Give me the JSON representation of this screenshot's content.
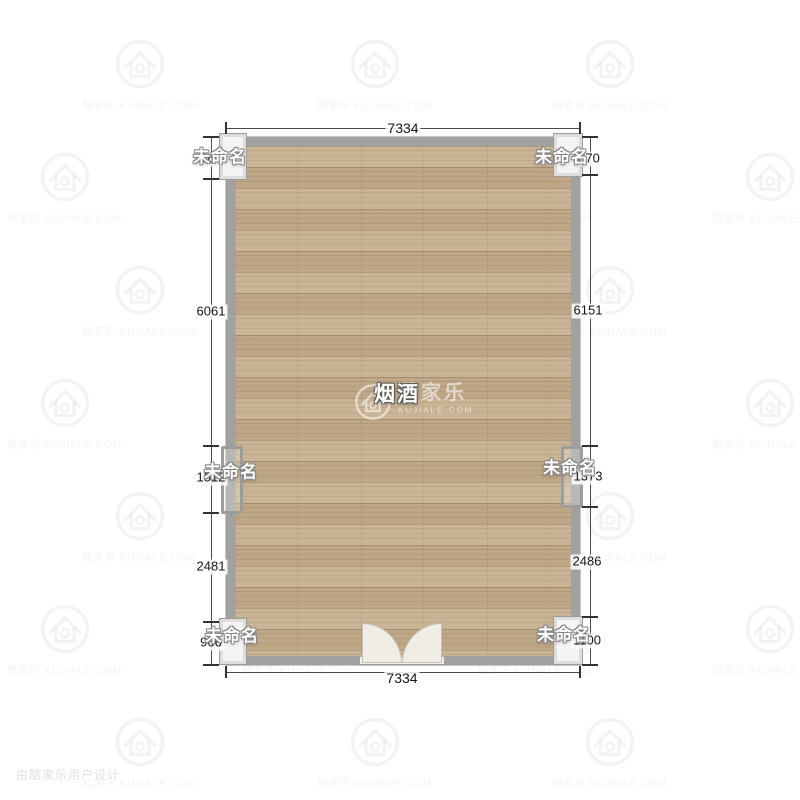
{
  "room": {
    "name": "烟酒"
  },
  "dims": {
    "top": "7334",
    "bottom": "7334",
    "left": [
      "960",
      "6061",
      "1512",
      "2481",
      "966"
    ],
    "right": [
      "870",
      "6151",
      "1373",
      "2486",
      "1100"
    ]
  },
  "openings": {
    "windows": [
      {
        "label": "未命名"
      },
      {
        "label": "未命名"
      },
      {
        "label": "未命名"
      },
      {
        "label": "未命名"
      },
      {
        "label": "未命名"
      },
      {
        "label": "未命名"
      }
    ]
  },
  "brand": {
    "name": "酷家乐",
    "domain": "KUJIALE.COM",
    "tile_text": "酷家乐 KUJIALE.COM",
    "footer_credit": "由酷家乐用户设计"
  },
  "colors": {
    "floor": "#c5ae8d",
    "wall": "#a1a1a1",
    "dim_text": "#151515",
    "label_text": "#ffffff",
    "watermark": "#f0f0f0"
  }
}
